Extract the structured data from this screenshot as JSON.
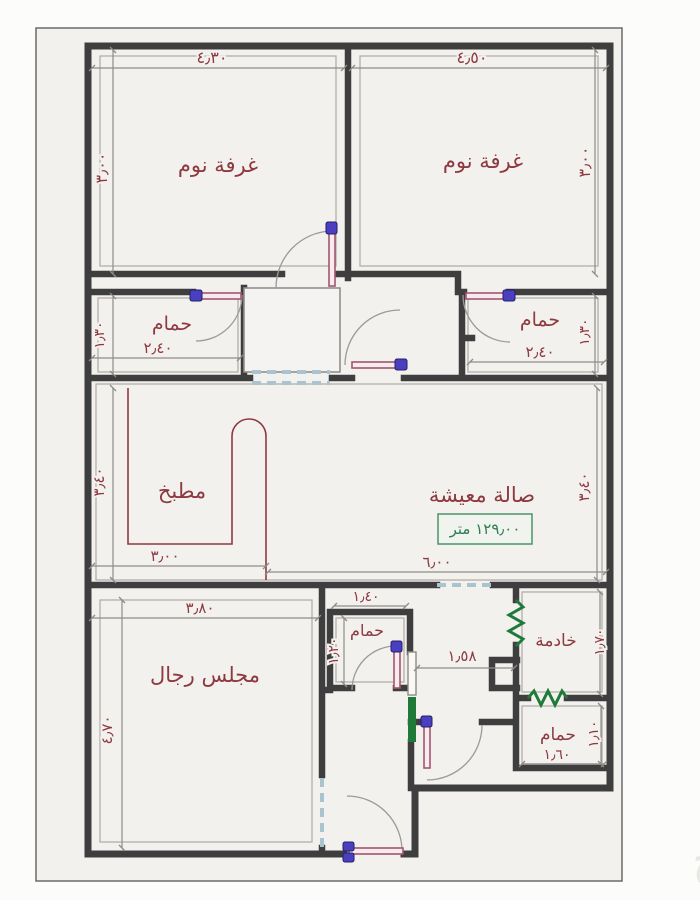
{
  "sheet": {
    "watermark": "حراج"
  },
  "colors": {
    "paper": "#f2f1ee",
    "wall": "#3f3e3e",
    "label_text": "#8e3940",
    "dimension_text": "#8e3940",
    "window_green": "#1f7a3a",
    "area_box_green": "#2e7d4f",
    "door_leaf": "#a3566e",
    "door_hinge": "#4a3fc0",
    "dashed_opening": "#a9c4cf"
  },
  "rooms": {
    "bedroom_left": {
      "label": "غرفة نوم",
      "width": "٤٫٣٠",
      "height": "٣٫٠٠"
    },
    "bedroom_right": {
      "label": "غرفة نوم",
      "width": "٤٫٥٠",
      "height": "٣٫٠٠"
    },
    "bath_left": {
      "label": "حمام",
      "width": "٢٫٤٠",
      "height": "١٫٣٠"
    },
    "bath_right": {
      "label": "حمام",
      "width": "٢٫٤٠",
      "height": "١٫٣٠"
    },
    "kitchen": {
      "label": "مطبخ",
      "width": "٣٫٠٠",
      "height": "٣٫٤٠"
    },
    "living": {
      "label": "صالة معيشة",
      "area": "١٢٩٫٠٠ متر",
      "width": "٦٫٠٠",
      "height": "٣٫٤٠"
    },
    "majlis": {
      "label": "مجلس رجال",
      "width": "٣٫٨٠",
      "height": "٤٫٧٠"
    },
    "bath_middle": {
      "label": "حمام",
      "width": "١٫٤٠",
      "height": "١٫٢٠"
    },
    "maid": {
      "label": "خادمة",
      "height": "١٫٧٠"
    },
    "bath_bottom": {
      "label": "حمام",
      "width": "١٫٦٠",
      "height": "١٫١٠"
    },
    "hallway": {
      "width": "١٫٥٨"
    }
  }
}
